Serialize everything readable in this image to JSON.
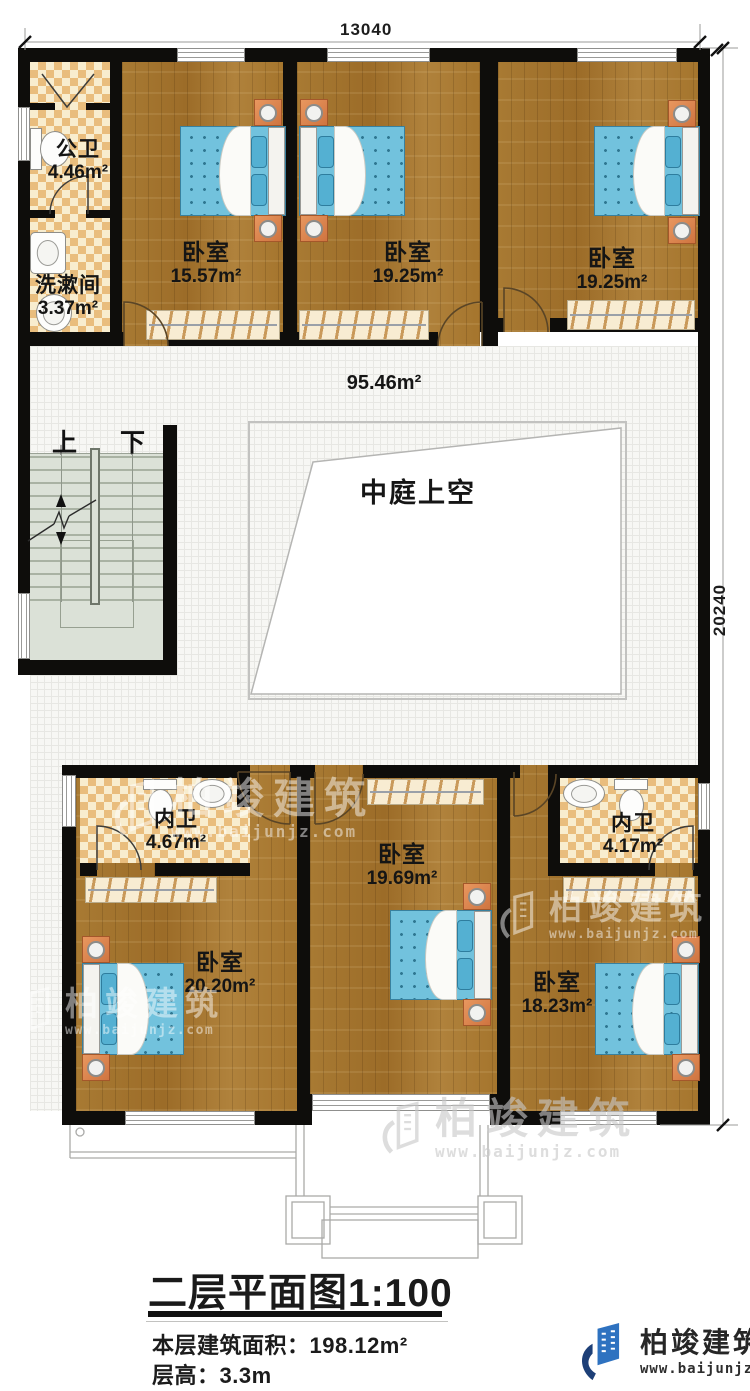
{
  "plan": {
    "scale_title": "二层平面图1:100",
    "floor_area_label": "本层建筑面积：",
    "floor_area_value": "198.12m²",
    "floor_height_label": "层高：",
    "floor_height_value": "3.3m"
  },
  "dimensions": {
    "top": "13040",
    "right": "20240"
  },
  "rooms": [
    {
      "name": "公卫",
      "area": "4.46m²"
    },
    {
      "name": "洗漱间",
      "area": "3.37m²"
    },
    {
      "name": "卧室",
      "area": "15.57m²"
    },
    {
      "name": "卧室",
      "area": "19.25m²"
    },
    {
      "name": "卧室",
      "area": "19.25m²"
    },
    {
      "name": "内卫",
      "area": "4.67m²"
    },
    {
      "name": "卧室",
      "area": "20.20m²"
    },
    {
      "name": "卧室",
      "area": "19.69m²"
    },
    {
      "name": "内卫",
      "area": "4.17m²"
    },
    {
      "name": "卧室",
      "area": "18.23m²"
    }
  ],
  "corridor": {
    "area": "95.46m²"
  },
  "courtyard": {
    "label": "中庭上空"
  },
  "stairs": {
    "up": "上",
    "down": "下"
  },
  "brand": {
    "name": "柏竣建筑",
    "url": "www.baijunjz.com"
  },
  "watermark": {
    "name": "柏竣建筑",
    "url": "www.baijunjz.com"
  },
  "colors": {
    "wall": "#0e0d0b",
    "wood": "#a5752d",
    "tile_checker": "#e9bd7d",
    "bed": "#72c2dd",
    "brand_blue": "#2e72c0",
    "brand_navy": "#1d3f77"
  }
}
